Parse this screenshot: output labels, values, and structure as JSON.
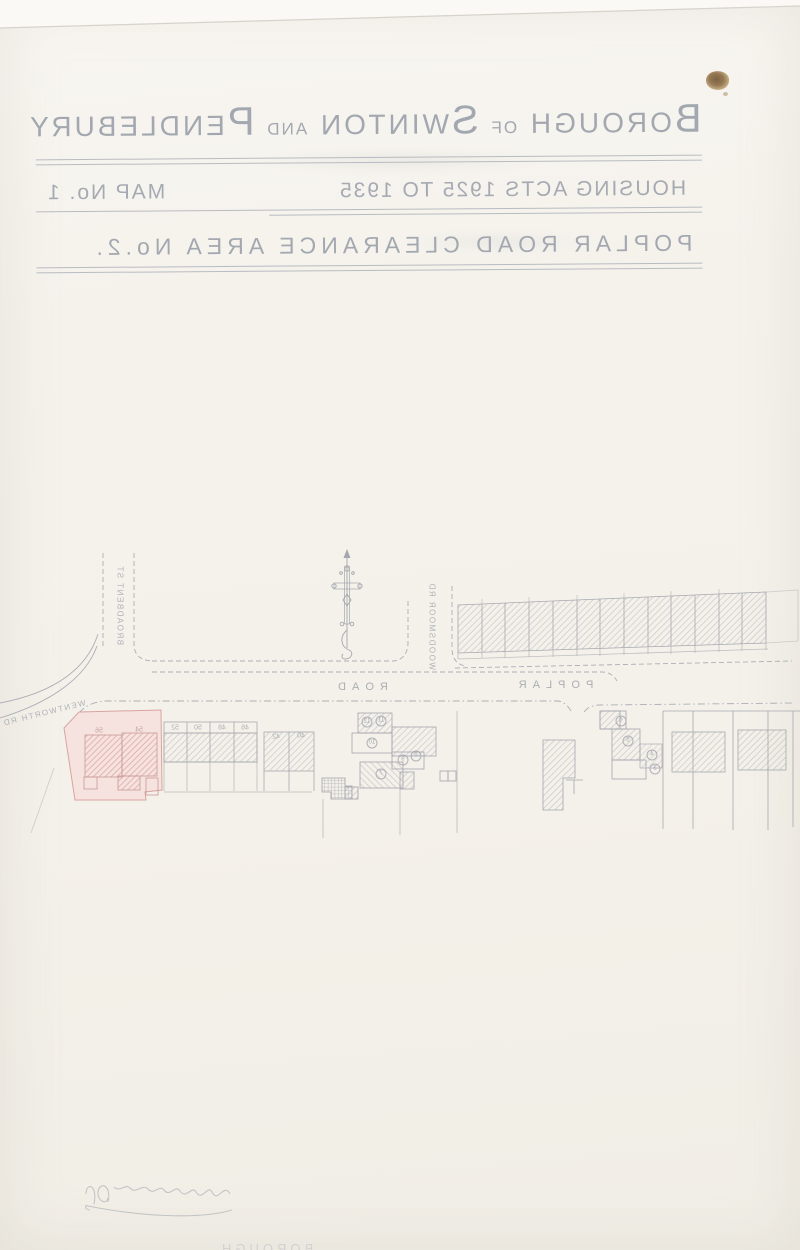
{
  "title": {
    "line1": {
      "cap1": "B",
      "rest1": "OROUGH",
      "of": "OF",
      "cap2": "S",
      "rest2": "WINTON",
      "and": "AND",
      "cap3": "P",
      "rest3": "ENDLEBURY"
    },
    "line2": {
      "left": "HOUSING ACTS 1925 TO 1935",
      "right": "MAP No. 1"
    },
    "line3": "POPLAR ROAD CLEARANCE AREA No.2."
  },
  "map": {
    "street_labels": {
      "broadbent": "BROADBENT ST",
      "woodsmoor": "WOODSMOOR RD",
      "wentworth": "WENTWORTH RD",
      "poplar": "POPLAR",
      "road": "ROAD"
    },
    "house_numbers": [
      "56",
      "54",
      "52",
      "50",
      "48",
      "46",
      "42",
      "40"
    ],
    "plot_numbers": [
      "12",
      "11",
      "10",
      "9",
      "8",
      "7",
      "6",
      "5",
      "4",
      "3"
    ],
    "colors": {
      "ink": "#a8abb2",
      "pink_fill": "#f6e2df",
      "pink_line": "#d9a4a0",
      "red_hatch": "#cd837e",
      "stain": "#7a5c38"
    }
  },
  "footer": {
    "partial_text": "BOROUGH"
  }
}
